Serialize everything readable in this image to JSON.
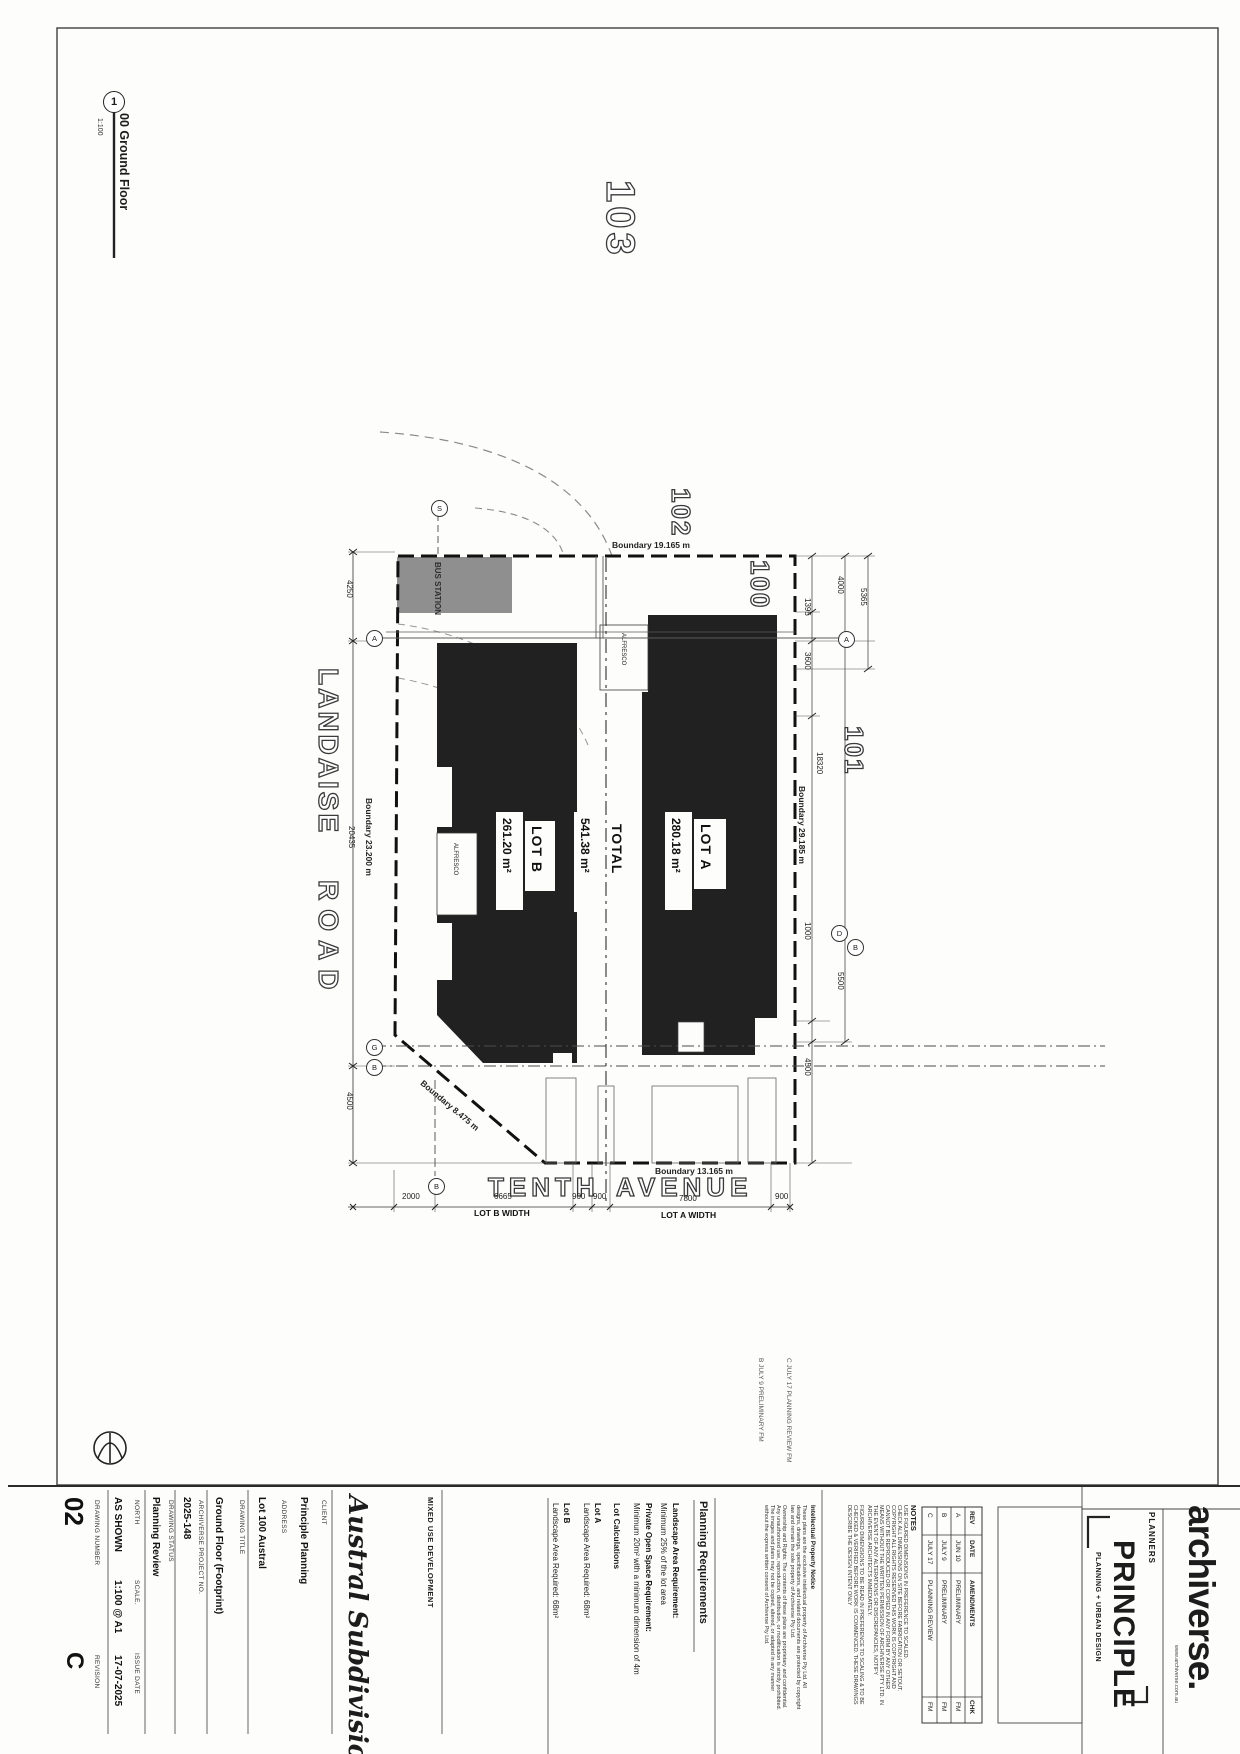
{
  "drawing_label": {
    "number": "1",
    "title": "00 Ground Floor",
    "scale": "1:100"
  },
  "plan": {
    "parcels": {
      "p100": "100",
      "p101": "101",
      "p102": "102",
      "p103": "103"
    },
    "roads": {
      "landaise_a": "LANDAISE",
      "landaise_b": "ROAD",
      "tenth_a": "TENTH",
      "tenth_b": "AVENUE"
    },
    "boundaries": {
      "top": "Boundary  19.165 m",
      "left": "Boundary  23.200 m",
      "right": "Boundary  29.185 m",
      "chamfer": "Boundary  8.475 m",
      "bottom": "Boundary  13.165 m"
    },
    "lots": {
      "lot_a": {
        "name": "LOT A",
        "area": "280.18 m²"
      },
      "lot_b": {
        "name": "LOT B",
        "area": "261.20 m²"
      },
      "total": {
        "name": "TOTAL",
        "area": "541.38 m²"
      }
    },
    "features": {
      "bus_station": "BUS STATION",
      "alfresco_a": "ALFRESCO",
      "alfresco_b": "ALFRESCO"
    },
    "markers": {
      "s": "S",
      "a_left": "A",
      "a_right": "A",
      "g": "G",
      "b_left": "B",
      "d_right": "D",
      "b_right": "B",
      "b_bottom": "B"
    },
    "dims": {
      "d4250": "4250",
      "d20435": "20435",
      "d4500_left": "4500",
      "d4000": "4000",
      "d5365": "5365",
      "d1395": "1395",
      "d3600": "3600",
      "d18320": "18320",
      "d1000": "1000",
      "d5500": "5500",
      "d4500_right": "4500",
      "d2000": "2000",
      "d6665": "6665",
      "d900a": "900",
      "d900b": "900",
      "d7800": "7800",
      "d900c": "900"
    },
    "width_labels": {
      "lot_b": "LOT B WIDTH",
      "lot_a": "LOT A WIDTH"
    }
  },
  "rev_ghost": {
    "b": "B   JULY 9   PRELIMINARY   FM",
    "c": "C   JULY 17   PLANNING REVIEW   FM"
  },
  "title_block": {
    "drawing_number": {
      "label": "DRAWING NUMBER",
      "value": "02"
    },
    "revision": {
      "label": "REVISION",
      "value": "C"
    },
    "north": {
      "label": "NORTH",
      "value": "AS SHOWN"
    },
    "scale": {
      "label": "SCALE.",
      "value": "1:100 @ A1"
    },
    "issue_date": {
      "label": "ISSUE DATE",
      "value": "17-07-2025"
    },
    "status": {
      "label": "DRAWING STATUS",
      "value": "Planning Review"
    },
    "project_no": {
      "label": "ARCHIVERSE PROJECT NO.",
      "value": "2025-148"
    },
    "drawing_title": {
      "label": "DRAWING TITLE",
      "value": "Ground Floor (Footprint)"
    },
    "address": {
      "label": "ADDRESS",
      "value": "Lot 100 Austral"
    },
    "client": {
      "label": "CLIENT",
      "value": "Principle Planning"
    },
    "project_name": "Austral Subdivision",
    "project_type": "MIXED USE DEVELOPMENT"
  },
  "planning_requirements": {
    "header": "Planning Requirements",
    "landscape_req_label": "Landscape Area Requirement:",
    "landscape_req_value": "Minimum 25% of the lot area",
    "pos_req_label": "Private Open Space Requirement:",
    "pos_req_value": "Minimum 20m² with a minimum dimension of 4m",
    "lot_calcs_header": "Lot Calculations",
    "lot_a_label": "Lot A",
    "lot_a_value": "Landscape Area Required: 68m²",
    "lot_b_label": "Lot B",
    "lot_b_value": "Landscape Area Required: 68m²"
  },
  "notes": {
    "header": "NOTES",
    "lines": [
      "USE FIGURED DIMENSIONS IN PREFERENCE TO SCALED.",
      "CHECK ALL DIMENSIONS ON SITE BEFORE FABRICATION OR SETOUT.",
      "COPYRIGHT ALL RIGHTS RESERVED THIS WORK IS COPYRIGHT AND",
      "CANNOT BE REPRODUCED OR COPIED IN ANY FORM BY ANY OTHER",
      "MEANS WITHOUT THE WRITTEN PERMISSION OF ARCHIVERSE PTY LTD. IN",
      "THE EVENT OF ANY ALTERATIONS OR DISCREPANCIES, NOTIFY",
      "ARCHIVERSE ARCHITECTS IMMEDIATELY.",
      "FIGURED DIMENSIONS TO BE READ IN PREFERENCE TO SCALING & TO BE",
      "CHECKED & VERIFIED BEFORE WORK IS COMMENCED. THESE DRAWINGS",
      "DESCRIBE THE DESIGN INTENT ONLY"
    ]
  },
  "ip_notice": {
    "header": "Intellectual Property Notice",
    "lines": [
      "These plans are the exclusive intellectual property of Archiverse Pty Ltd. All",
      "designs, drawings, specifications, and related documents are protected by copyright",
      "law and remain the sole property of Archiverse Pty Ltd.",
      "Ownership and Rights: The contents of these plans are proprietary and confidential.",
      "Any unauthorized use, reproduction, distribution, or modification is strictly prohibited.",
      "The images and plans may not be copied, altered, or adapted in any manner",
      "without the express written consent of Archiverse Pty Ltd."
    ]
  },
  "rev_table": {
    "headers": {
      "rev": "REV",
      "date": "DATE",
      "amendments": "AMENDMENTS",
      "chk": "CHK"
    },
    "rows": [
      {
        "rev": "A",
        "date": "JUN 10",
        "amendment": "PRELIMINARY",
        "chk": "FM"
      },
      {
        "rev": "B",
        "date": "JULY 9",
        "amendment": "PRELIMINARY",
        "chk": "FM"
      },
      {
        "rev": "C",
        "date": "JULY 17",
        "amendment": "PLANNING REVIEW",
        "chk": "FM"
      }
    ]
  },
  "branding": {
    "planners": "PLANNERS",
    "principle": "PRINCIPLE",
    "principle_sub": "PLANNING + URBAN DESIGN",
    "archiverse": "archiverse.",
    "website": "www.archiverse.com.au"
  }
}
